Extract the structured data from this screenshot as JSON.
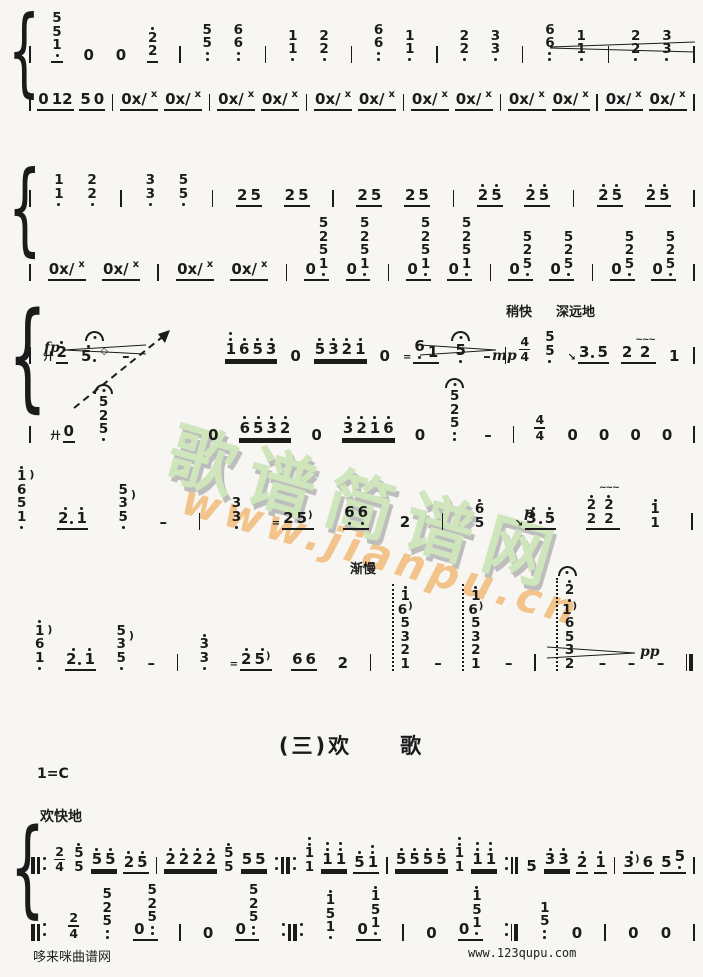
{
  "titles": {
    "section": "(三)欢　　歌",
    "key": "1=C",
    "tempo": "欢快地"
  },
  "annotations": {
    "shaokuai": "稍快",
    "shenyuandi": "深远地",
    "jianman": "渐慢"
  },
  "dynamics": {
    "fp": "fp",
    "mp": "mp",
    "p": "p",
    "pp": "pp"
  },
  "watermark": {
    "brand": "歌谱简谱网",
    "url": "www.jianpu.cn",
    "brand_color": "#cfe5bc",
    "url_color": "#f2c48b",
    "shadow_color": "#bdbdbd"
  },
  "footer": {
    "left": "哆来咪曲谱网",
    "right": "www.123qupu.com"
  },
  "glyphs": {
    "brace": "{",
    "x": "x",
    "harm": "◇",
    "shake": "廾",
    "mord": "=",
    "slide": "↘",
    "trill": "~~~",
    "arp": ")"
  },
  "rows": {
    "s1r1": [
      {
        "b": "|"
      },
      {
        "s": [
          "5",
          "5",
          "1."
        ],
        "u": 1
      },
      {
        "g": [
          "0"
        ]
      },
      {
        "g": [
          "0"
        ]
      },
      {
        "s": [
          "2'",
          "2"
        ],
        "u": 1
      },
      {
        "b": "|"
      },
      {
        "s": [
          "5",
          "5.."
        ]
      },
      {
        "s": [
          "6",
          "6.."
        ]
      },
      {
        "b": "|"
      },
      {
        "s": [
          "1",
          "1."
        ]
      },
      {
        "s": [
          "2",
          "2."
        ]
      },
      {
        "b": "|"
      },
      {
        "s": [
          "6",
          "6.."
        ]
      },
      {
        "s": [
          "1",
          "1."
        ]
      },
      {
        "b": "|"
      },
      {
        "s": [
          "2",
          "2."
        ]
      },
      {
        "s": [
          "3",
          "3."
        ]
      },
      {
        "b": "|"
      },
      {
        "s": [
          "6",
          "6.."
        ]
      },
      {
        "s": [
          "1",
          "1."
        ]
      },
      {
        "b": "|"
      },
      {
        "s": [
          "2",
          "2."
        ]
      },
      {
        "s": [
          "3",
          "3."
        ]
      },
      {
        "b": "|"
      }
    ],
    "s1r2": [
      {
        "b": "|"
      },
      {
        "g": [
          "0",
          "12"
        ],
        "u": 1
      },
      {
        "g": [
          "5",
          "0"
        ],
        "u": 1
      },
      {
        "b": "|"
      },
      {
        "g": [
          "0x/"
        ],
        "sup": "x",
        "u": 1
      },
      {
        "g": [
          "0x/"
        ],
        "sup": "x",
        "u": 1
      },
      {
        "b": "|"
      },
      {
        "g": [
          "0x/"
        ],
        "sup": "x",
        "u": 1
      },
      {
        "g": [
          "0x/"
        ],
        "sup": "x",
        "u": 1
      },
      {
        "b": "|"
      },
      {
        "g": [
          "0x/"
        ],
        "sup": "x",
        "u": 1
      },
      {
        "g": [
          "0x/"
        ],
        "sup": "x",
        "u": 1
      },
      {
        "b": "|"
      },
      {
        "g": [
          "0x/"
        ],
        "sup": "x",
        "u": 1
      },
      {
        "g": [
          "0x/"
        ],
        "sup": "x",
        "u": 1
      },
      {
        "b": "|"
      },
      {
        "g": [
          "0x/"
        ],
        "sup": "x",
        "u": 1
      },
      {
        "g": [
          "0x/"
        ],
        "sup": "x",
        "u": 1
      },
      {
        "b": "|"
      },
      {
        "g": [
          "0x/"
        ],
        "sup": "x",
        "u": 1
      },
      {
        "g": [
          "0x/"
        ],
        "sup": "x",
        "u": 1
      },
      {
        "b": "|"
      }
    ],
    "s2r1": [
      {
        "b": "|"
      },
      {
        "s": [
          "1",
          "1."
        ]
      },
      {
        "s": [
          "2",
          "2."
        ]
      },
      {
        "b": "|"
      },
      {
        "s": [
          "3",
          "3."
        ]
      },
      {
        "s": [
          "5",
          "5."
        ]
      },
      {
        "b": "|"
      },
      {
        "g": [
          "2",
          "5"
        ],
        "u": 1
      },
      {
        "g": [
          "2",
          "5"
        ],
        "u": 1
      },
      {
        "b": "|"
      },
      {
        "g": [
          "2",
          "5"
        ],
        "u": 1
      },
      {
        "g": [
          "2",
          "5"
        ],
        "u": 1
      },
      {
        "b": "|"
      },
      {
        "g": [
          "2'",
          "5'"
        ],
        "u": 1
      },
      {
        "g": [
          "2'",
          "5'"
        ],
        "u": 1
      },
      {
        "b": "|"
      },
      {
        "g": [
          "2'",
          "5'"
        ],
        "u": 1
      },
      {
        "g": [
          "2'",
          "5'"
        ],
        "u": 1
      },
      {
        "b": "|"
      }
    ],
    "s2r2": [
      {
        "b": "|"
      },
      {
        "g": [
          "0x/"
        ],
        "sup": "x",
        "u": 1
      },
      {
        "g": [
          "0x/"
        ],
        "sup": "x",
        "u": 1
      },
      {
        "b": "|"
      },
      {
        "g": [
          "0x/"
        ],
        "sup": "x",
        "u": 1
      },
      {
        "g": [
          "0x/"
        ],
        "sup": "x",
        "u": 1
      },
      {
        "b": "|"
      },
      {
        "g": [
          "0",
          "5|2|5|1."
        ],
        "u": 1
      },
      {
        "g": [
          "0",
          "5|2|5|1."
        ],
        "u": 1
      },
      {
        "b": "|"
      },
      {
        "g": [
          "0",
          "5|2|5|1."
        ],
        "u": 1
      },
      {
        "g": [
          "0",
          "5|2|5|1."
        ],
        "u": 1
      },
      {
        "b": "|"
      },
      {
        "g": [
          "0",
          "5|2|5."
        ],
        "u": 1
      },
      {
        "g": [
          "0",
          "5|2|5."
        ],
        "u": 1
      },
      {
        "b": "|"
      },
      {
        "g": [
          "0",
          "5|2|5."
        ],
        "u": 1
      },
      {
        "g": [
          "0",
          "5|2|5."
        ],
        "u": 1
      },
      {
        "b": "|"
      }
    ],
    "s3r1": [
      {
        "b": "|"
      },
      {
        "pre": "shake",
        "g": [
          "2'"
        ],
        "u": 1
      },
      {
        "g": [
          "5'+"
        ],
        "dec": "ferm",
        "sup": "harm"
      },
      {
        "g": [
          "–"
        ]
      },
      {
        "sp": 70
      },
      {
        "g": [
          "1''",
          "6'",
          "5'",
          "3'"
        ],
        "u": 2
      },
      {
        "g": [
          "0"
        ]
      },
      {
        "g": [
          "5'",
          "3'",
          "2'",
          "1'"
        ],
        "u": 2
      },
      {
        "g": [
          "0"
        ]
      },
      {
        "pre": "mord",
        "g": [
          "6.",
          "1"
        ],
        "u": 1
      },
      {
        "g": [
          "5."
        ],
        "dec": "ferm"
      },
      {
        "g": [
          "–"
        ]
      },
      {
        "b": "|"
      },
      {
        "ts": [
          "4",
          "4"
        ]
      },
      {
        "s": [
          "5",
          "5."
        ]
      },
      {
        "pre": "slide",
        "g": [
          "3+",
          "5"
        ],
        "u": 1
      },
      {
        "g": [
          "2",
          "2~"
        ],
        "u": 1
      },
      {
        "g": [
          "1"
        ]
      },
      {
        "b": "|"
      }
    ],
    "s3r2": [
      {
        "b": "|"
      },
      {
        "pre": "shake",
        "g": [
          "0"
        ],
        "u": 1
      },
      {
        "s": [
          "5",
          "2",
          "5."
        ],
        "dec": "ferm"
      },
      {
        "sp": 56
      },
      {
        "g": [
          "0"
        ]
      },
      {
        "g": [
          "6'",
          "5'",
          "3'",
          "2'"
        ],
        "u": 2
      },
      {
        "g": [
          "0"
        ]
      },
      {
        "g": [
          "3'",
          "2'",
          "1'",
          "6'"
        ],
        "u": 2
      },
      {
        "g": [
          "0"
        ]
      },
      {
        "s": [
          "5",
          "2",
          "5.."
        ],
        "dec": "ferm"
      },
      {
        "g": [
          "–"
        ]
      },
      {
        "b": "|"
      },
      {
        "ts": [
          "4",
          "4"
        ]
      },
      {
        "g": [
          "0"
        ]
      },
      {
        "g": [
          "0"
        ]
      },
      {
        "g": [
          "0"
        ]
      },
      {
        "g": [
          "0"
        ]
      },
      {
        "b": "|"
      }
    ],
    "s4r1": [
      {
        "s": [
          "1'",
          "6",
          "5",
          "1."
        ],
        "dec": "arp"
      },
      {
        "g": [
          "2'+",
          "1'"
        ],
        "u": 1
      },
      {
        "s": [
          "5",
          "3",
          "5."
        ],
        "dec": "arp"
      },
      {
        "g": [
          "–"
        ]
      },
      {
        "b": "|"
      },
      {
        "s": [
          "3",
          "3."
        ]
      },
      {
        "pre": "mord",
        "g": [
          "2",
          "5)"
        ],
        "u": 1
      },
      {
        "g": [
          "6.",
          "6."
        ],
        "u": 1
      },
      {
        "g": [
          "2"
        ]
      },
      {
        "b": "|"
      },
      {
        "s": [
          "6'",
          "5"
        ]
      },
      {
        "pre": "slide",
        "g": [
          "3'+",
          "5'"
        ],
        "u": 1
      },
      {
        "g": [
          "2'|2",
          "2'~|2"
        ],
        "u": 1
      },
      {
        "s": [
          "1'",
          "1"
        ]
      },
      {
        "b": "|"
      }
    ],
    "s5r1": [
      {
        "s": [
          "1'",
          "6",
          "1."
        ],
        "dec": "arp"
      },
      {
        "g": [
          "2'+",
          "1'"
        ],
        "u": 1
      },
      {
        "s": [
          "5",
          "3",
          "5."
        ],
        "dec": "arp"
      },
      {
        "g": [
          "–"
        ]
      },
      {
        "b": "|"
      },
      {
        "s": [
          "3'",
          "3."
        ]
      },
      {
        "pre": "mord",
        "g": [
          "2'",
          "5')"
        ],
        "u": 1
      },
      {
        "g": [
          "6",
          "6"
        ],
        "u": 1
      },
      {
        "g": [
          "2"
        ]
      },
      {
        "b": "|"
      },
      {
        "s": [
          "1'",
          "6)",
          "5",
          "3",
          "2",
          "1"
        ],
        "dec": "arpline"
      },
      {
        "g": [
          "–"
        ]
      },
      {
        "s": [
          "1'",
          "6)",
          "5",
          "3",
          "2",
          "1"
        ],
        "dec": "arpline"
      },
      {
        "g": [
          "–"
        ]
      },
      {
        "b": "|"
      },
      {
        "s": [
          "2'",
          "1')",
          "6",
          "5",
          "3",
          "2"
        ],
        "dec": "arpline ferm"
      },
      {
        "g": [
          "–"
        ]
      },
      {
        "g": [
          "–"
        ]
      },
      {
        "g": [
          "–"
        ]
      },
      {
        "b": "final"
      }
    ],
    "s6r1": [
      {
        "b": "||:"
      },
      {
        "ts": [
          "2",
          "4"
        ]
      },
      {
        "s": [
          "5'",
          "5"
        ]
      },
      {
        "g": [
          "5'",
          "5'"
        ],
        "u": 2
      },
      {
        "g": [
          "2'",
          "5'"
        ],
        "u": 1
      },
      {
        "b": "|"
      },
      {
        "g": [
          "2'",
          "2'",
          "2'",
          "2'"
        ],
        "u": 2
      },
      {
        "s": [
          "5'",
          "5"
        ]
      },
      {
        "g": [
          "5",
          "5"
        ],
        "u": 2
      },
      {
        "b": ":||:"
      },
      {
        "s": [
          "1''",
          "1"
        ]
      },
      {
        "g": [
          "1''",
          "1''"
        ],
        "u": 2
      },
      {
        "g": [
          "5'",
          "1''"
        ],
        "u": 1
      },
      {
        "b": "|"
      },
      {
        "g": [
          "5'",
          "5'",
          "5'",
          "5'"
        ],
        "u": 2
      },
      {
        "s": [
          "1''",
          "1"
        ]
      },
      {
        "g": [
          "1''",
          "1''"
        ],
        "u": 2
      },
      {
        "b": ":||"
      },
      {
        "g": [
          "5"
        ]
      },
      {
        "g": [
          "3'",
          "3'"
        ],
        "u": 2
      },
      {
        "g": [
          "2'"
        ],
        "u": 1
      },
      {
        "g": [
          "1'"
        ],
        "u": 1
      },
      {
        "b": "|"
      },
      {
        "g": [
          "3')",
          "6"
        ],
        "u": 1
      },
      {
        "g": [
          "5",
          "5."
        ],
        "u": 1
      },
      {
        "b": "|"
      }
    ],
    "s6r2": [
      {
        "b": "||:"
      },
      {
        "ts": [
          "2",
          "4"
        ]
      },
      {
        "s": [
          "5",
          "2",
          "5.."
        ]
      },
      {
        "g": [
          "0",
          "5|2|5.."
        ],
        "u": 1
      },
      {
        "b": "|"
      },
      {
        "g": [
          "0"
        ]
      },
      {
        "g": [
          "0",
          "5|2|5.."
        ],
        "u": 1
      },
      {
        "b": ":||:"
      },
      {
        "s": [
          "1'",
          "5",
          "1."
        ]
      },
      {
        "g": [
          "0",
          "1'|5|1."
        ],
        "u": 1
      },
      {
        "b": "|"
      },
      {
        "g": [
          "0"
        ]
      },
      {
        "g": [
          "0",
          "1'|5|1."
        ],
        "u": 1
      },
      {
        "b": ":||"
      },
      {
        "s": [
          "1",
          "5.."
        ]
      },
      {
        "g": [
          "0"
        ]
      },
      {
        "b": "|"
      },
      {
        "g": [
          "0"
        ]
      },
      {
        "g": [
          "0"
        ]
      },
      {
        "b": "|"
      }
    ]
  }
}
